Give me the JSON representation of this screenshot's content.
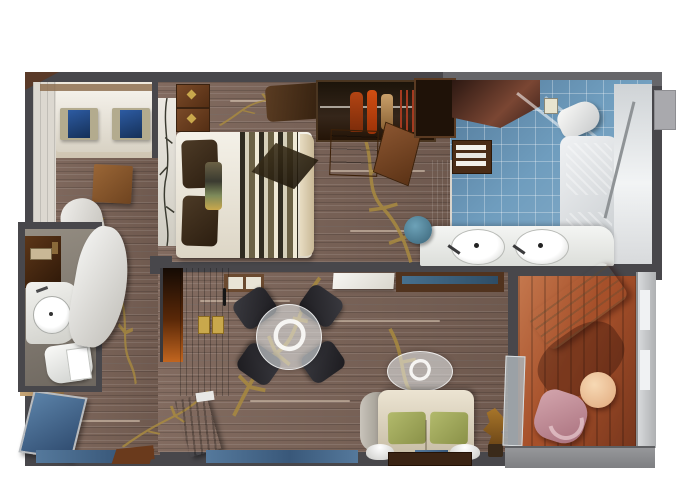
{
  "scene": {
    "type": "3d-floor-plan",
    "subject": "Top-down 3D rendered floor plan of a suite with bedroom, walk-in wardrobe, two bathrooms, living-dining room and private balcony",
    "background": "#ffffff"
  },
  "palette": {
    "wall": "#48474b",
    "wood_floor": "#7b6357",
    "gold_inlay": "#a8893f",
    "bathroom_tile": "#6f9dbe",
    "tub_water": "#52c2c4",
    "balcony_deck": "#a6502a",
    "sofa_cream": "#ded3bf",
    "cushion_green": "#9fa85c",
    "dining_chair_black": "#232227",
    "entry_door_glass": "#4a6f94",
    "window_glass": "#4c7296",
    "pink_chair": "#c6939d",
    "patio_table_peach": "#f2c9a1",
    "vanity_stool_teal": "#4e7e94",
    "wardrobe_wood": "#5a2413"
  },
  "rooms": [
    {
      "name": "sitting-nook",
      "furniture": [
        "white daybed",
        "two tan pillows with blue centers",
        "wood side table",
        "white closet doors"
      ]
    },
    {
      "name": "bedroom",
      "furniture": [
        "double bed with white duvet",
        "striped bed runner",
        "two dark pillows",
        "striped bolster",
        "nightstand with gold knobs",
        "headboard art panel",
        "brown fur rug",
        "bench with cream cushions"
      ]
    },
    {
      "name": "walk-in-wardrobe",
      "furniture": [
        "hanging clothes",
        "drawer unit",
        "open wood door",
        "dark cabinet"
      ]
    },
    {
      "name": "master-bathroom",
      "furniture": [
        "double-sink vanity",
        "teal vanity stool",
        "toilet",
        "tub with turquoise water",
        "towel shelf",
        "glass shower wall",
        "dark mirror counter"
      ]
    },
    {
      "name": "guest-bathroom",
      "furniture": [
        "round washbasin",
        "toilet",
        "dark vanity cabinet",
        "curved white partition"
      ]
    },
    {
      "name": "corridor",
      "furniture": [
        "white chaise",
        "wood stool"
      ]
    },
    {
      "name": "entry-hall",
      "furniture": [
        "blue glass entry door",
        "tan console",
        "open wood door",
        "red-wood wardrobe doors with gold plates",
        "lit niche"
      ]
    },
    {
      "name": "living-room",
      "furniture": [
        "round glass dining table",
        "four black dining chairs",
        "oval glass coffee table",
        "cream sofa with two green cushions",
        "two white half-dome lamps",
        "floor plant",
        "sideboard with blue glass",
        "white console"
      ]
    },
    {
      "name": "balcony",
      "furniture": [
        "cream sun lounger",
        "peach round table",
        "pink lounge chair",
        "glass sliding door",
        "glass railing"
      ]
    }
  ],
  "counts": {
    "dining_chairs": 4,
    "sinks_master_bath": 2,
    "pillows_sitting_nook": 2,
    "green_cushions": 2
  }
}
